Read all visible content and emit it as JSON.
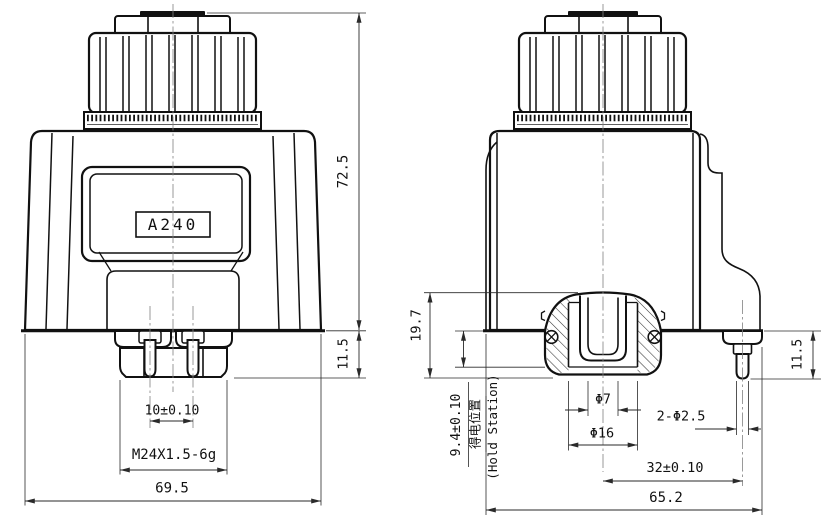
{
  "front_view": {
    "model_label": "A240",
    "overall_height": "72.5",
    "nut_height": "11.5",
    "pin_spacing": "10±0.10",
    "thread_spec": "M24X1.5-6g",
    "overall_width": "69.5"
  },
  "side_view": {
    "connector_depth": "19.7",
    "hold_position": "9.4±0.10",
    "hold_label_cn": "得电位置",
    "hold_label_en": "(Hold Station)",
    "inner_diameter": "Φ7",
    "outer_diameter": "Φ16",
    "pin_holes": "2-Φ2.5",
    "pin_offset": "32±0.10",
    "overall_width": "65.2",
    "pin_length": "11.5"
  },
  "colors": {
    "line": "#111111",
    "background": "#ffffff",
    "centerline": "#818181"
  }
}
